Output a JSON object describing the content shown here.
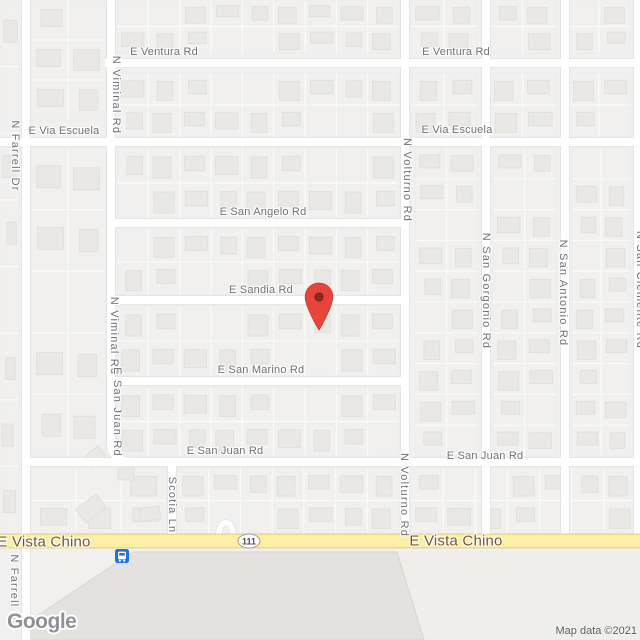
{
  "attribution": {
    "text": "Map data ©2021"
  },
  "logo": {
    "text": "Google"
  },
  "route_shield": {
    "text": "111",
    "x": 249,
    "y": 541
  },
  "marker": {
    "x": 319,
    "tip_y": 331,
    "color": "#E7453C",
    "stroke": "#C53A30",
    "dot_color": "#8C251D"
  },
  "transit_stop": {
    "x": 115,
    "y": 549,
    "color": "#1A73E8"
  },
  "palette": {
    "bg": "#F1F0EE",
    "parcel": "#FAFAF8",
    "block_outline": "#ECEBE9",
    "building": "#E9E8E5",
    "building_stroke": "#DEDDDA",
    "road_casing": "#E3E2E0",
    "road_fill": "#FFFFFF",
    "hwy_casing": "#EDD88C",
    "hwy_fill": "#FAEFA4",
    "big_building": "#E3E2DF",
    "big_building_stroke": "#D6D5D2",
    "lot": "#EFEEEB",
    "label": "#6E7076",
    "hwy_label": "#7D5327"
  },
  "labels": [
    {
      "text": "E Ventura Rd",
      "x": 164,
      "y": 52,
      "orient": "h",
      "kind": "road"
    },
    {
      "text": "E Ventura Rd",
      "x": 456,
      "y": 52,
      "orient": "h",
      "kind": "road"
    },
    {
      "text": "E Via Escuela",
      "x": 64,
      "y": 131,
      "orient": "h",
      "kind": "road"
    },
    {
      "text": "E Via Escuela",
      "x": 457,
      "y": 130,
      "orient": "h",
      "kind": "road"
    },
    {
      "text": "E San Angelo Rd",
      "x": 263,
      "y": 212,
      "orient": "h",
      "kind": "road"
    },
    {
      "text": "E Sandia Rd",
      "x": 261,
      "y": 290,
      "orient": "h",
      "kind": "road"
    },
    {
      "text": "E San Marino Rd",
      "x": 261,
      "y": 370,
      "orient": "h",
      "kind": "road"
    },
    {
      "text": "E San Juan Rd",
      "x": 225,
      "y": 451,
      "orient": "h",
      "kind": "road"
    },
    {
      "text": "E San Juan Rd",
      "x": 485,
      "y": 456,
      "orient": "h",
      "kind": "road"
    },
    {
      "text": "E Vista Chino",
      "x": 44,
      "y": 542,
      "orient": "h",
      "kind": "highway"
    },
    {
      "text": "E Vista Chino",
      "x": 456,
      "y": 541,
      "orient": "h",
      "kind": "highway"
    },
    {
      "text": "N Farrell Dr",
      "x": 15,
      "y": 156,
      "orient": "v",
      "kind": "road"
    },
    {
      "text": "N Farrell Dr",
      "x": 14,
      "y": 590,
      "orient": "v",
      "kind": "road"
    },
    {
      "text": "N Viminal Rd",
      "x": 116,
      "y": 95,
      "orient": "v",
      "kind": "road"
    },
    {
      "text": "N Viminal Rd",
      "x": 114,
      "y": 336,
      "orient": "v",
      "kind": "road"
    },
    {
      "text": "E San Juan Rd",
      "x": 117,
      "y": 412,
      "orient": "v",
      "kind": "road"
    },
    {
      "text": "N Volturno Rd",
      "x": 407,
      "y": 180,
      "orient": "v",
      "kind": "road"
    },
    {
      "text": "N Volturno Rd",
      "x": 404,
      "y": 495,
      "orient": "v",
      "kind": "road"
    },
    {
      "text": "N San Gorgonio Rd",
      "x": 486,
      "y": 291,
      "orient": "v",
      "kind": "road"
    },
    {
      "text": "N San Antonio Rd",
      "x": 563,
      "y": 293,
      "orient": "v",
      "kind": "road"
    },
    {
      "text": "N San Clemente Rd",
      "x": 640,
      "y": 290,
      "orient": "v",
      "kind": "road"
    },
    {
      "text": "Scotia Ln",
      "x": 172,
      "y": 505,
      "orient": "v",
      "kind": "road"
    }
  ],
  "roads": {
    "horizontal": [
      {
        "name": "E Ventura Rd",
        "y": 63,
        "x1": 105,
        "x2": 640
      },
      {
        "name": "E Via Escuela",
        "y": 142,
        "x1": 0,
        "x2": 640
      },
      {
        "name": "E San Angelo Rd",
        "y": 223,
        "x1": 111,
        "x2": 409
      },
      {
        "name": "E Sandia Rd",
        "y": 300,
        "x1": 111,
        "x2": 409
      },
      {
        "name": "E San Marino Rd",
        "y": 381,
        "x1": 111,
        "x2": 409
      },
      {
        "name": "E San Juan Rd",
        "y": 462,
        "x1": 26,
        "x2": 640
      }
    ],
    "vertical": [
      {
        "name": "N Farrell Dr",
        "x": 26,
        "y1": 0,
        "y2": 640
      },
      {
        "name": "N Viminal Rd",
        "x": 111,
        "y1": 0,
        "y2": 445
      },
      {
        "name": "N Volturno Rd",
        "x": 405,
        "y1": 0,
        "y2": 541
      },
      {
        "name": "N San Gorgonio Rd",
        "x": 486,
        "y1": 0,
        "y2": 541
      },
      {
        "name": "N San Antonio Rd",
        "x": 565,
        "y1": 0,
        "y2": 541
      },
      {
        "name": "N San Clemente Rd",
        "x": 638,
        "y1": 0,
        "y2": 541
      },
      {
        "name": "Scotia Ln",
        "x": 172,
        "y1": 462,
        "y2": 541
      }
    ],
    "curves": [
      {
        "d": "M111,444 Q111,462 135,462",
        "w": 8
      },
      {
        "d": "M219,534 C219,519 233,519 233,534",
        "w": 5.5
      }
    ],
    "highway": {
      "name": "E Vista Chino",
      "y": 541,
      "x1": 0,
      "x2": 640
    }
  },
  "blocks": [
    {
      "x": 117,
      "y": 0,
      "w": 282,
      "h": 53,
      "cols": 9,
      "rows": 2
    },
    {
      "x": 117,
      "y": 73,
      "w": 282,
      "h": 64,
      "cols": 9,
      "rows": 2
    },
    {
      "x": 117,
      "y": 148,
      "w": 282,
      "h": 70,
      "cols": 9,
      "rows": 2
    },
    {
      "x": 117,
      "y": 229,
      "w": 282,
      "h": 66,
      "cols": 9,
      "rows": 2
    },
    {
      "x": 117,
      "y": 306,
      "w": 282,
      "h": 70,
      "cols": 9,
      "rows": 2
    },
    {
      "x": 117,
      "y": 387,
      "w": 282,
      "h": 69,
      "cols": 9,
      "rows": 2
    },
    {
      "x": 177,
      "y": 468,
      "w": 222,
      "h": 65,
      "cols": 7,
      "rows": 2
    },
    {
      "x": 411,
      "y": 468,
      "w": 225,
      "h": 65,
      "cols": 7,
      "rows": 2
    },
    {
      "x": 415,
      "y": 148,
      "w": 63,
      "h": 308,
      "cols": 2,
      "rows": 10
    },
    {
      "x": 493,
      "y": 148,
      "w": 63,
      "h": 308,
      "cols": 2,
      "rows": 10
    },
    {
      "x": 572,
      "y": 148,
      "w": 58,
      "h": 308,
      "cols": 2,
      "rows": 10
    },
    {
      "x": 411,
      "y": 0,
      "w": 66,
      "h": 53,
      "cols": 2,
      "rows": 2
    },
    {
      "x": 489,
      "y": 0,
      "w": 67,
      "h": 53,
      "cols": 2,
      "rows": 2
    },
    {
      "x": 568,
      "y": 0,
      "w": 62,
      "h": 53,
      "cols": 2,
      "rows": 2
    },
    {
      "x": 411,
      "y": 73,
      "w": 66,
      "h": 64,
      "cols": 2,
      "rows": 2
    },
    {
      "x": 489,
      "y": 73,
      "w": 67,
      "h": 64,
      "cols": 2,
      "rows": 2
    },
    {
      "x": 568,
      "y": 73,
      "w": 62,
      "h": 64,
      "cols": 2,
      "rows": 2
    },
    {
      "x": 31,
      "y": 0,
      "w": 74,
      "h": 120,
      "cols": 2,
      "rows": 3
    },
    {
      "x": 31,
      "y": 148,
      "w": 74,
      "h": 308,
      "cols": 2,
      "rows": 5
    },
    {
      "x": 0,
      "y": 0,
      "w": 19,
      "h": 533,
      "cols": 1,
      "rows": 8
    },
    {
      "x": 31,
      "y": 468,
      "w": 135,
      "h": 65,
      "cols": 3,
      "rows": 2
    }
  ],
  "special_buildings": [
    [
      86,
      450,
      18,
      13,
      -38
    ],
    [
      78,
      500,
      26,
      17,
      -38
    ],
    [
      118,
      468,
      16,
      12,
      0
    ],
    [
      140,
      507,
      20,
      13,
      -8
    ]
  ],
  "big_building": {
    "points": "133,552 397,552 424,640 24,640 28,622"
  },
  "lot": {
    "points": "397,552 640,552 640,640 424,640"
  }
}
